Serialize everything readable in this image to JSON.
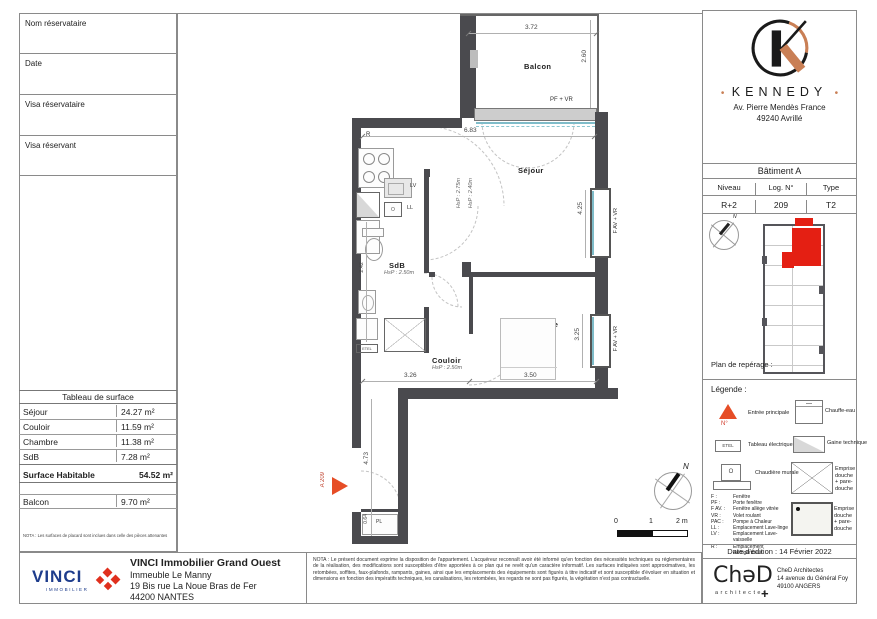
{
  "form": {
    "rows": [
      "Nom réservataire",
      "Date",
      "Visa réservataire",
      "Visa réservant"
    ]
  },
  "brand": {
    "dot": "•",
    "name": "KENNEDY",
    "address1": "Av. Pierre Mendès France",
    "address2": "49240 Avrillé"
  },
  "building": {
    "title": "Bâtiment A",
    "headers": [
      "Niveau",
      "Log. N°",
      "Type"
    ],
    "values": [
      "R+2",
      "209",
      "T2"
    ]
  },
  "reperage": {
    "label": "Plan de repérage :",
    "north": "N"
  },
  "legende": {
    "title": "Légende :",
    "entree": "Entrée principale",
    "entree_sub": "N°",
    "chauffe_eau": "Chauffe-eau",
    "etel": "ETEL",
    "tableau_electrique": "Tableau électrique",
    "gaine": "Gaine technique",
    "chaudiere": "Chaudière murale",
    "chaudiere_icon": "O",
    "emprise1": "Emprise douche + pare-douche",
    "emprise2": "Emprise douche + pare-douche",
    "abbr": [
      {
        "a": "F :",
        "d": "Fenêtre"
      },
      {
        "a": "PF :",
        "d": "Porte fenêtre"
      },
      {
        "a": "F AV. :",
        "d": "Fenêtre allège vitrée"
      },
      {
        "a": "VR :",
        "d": "Volet roulant"
      },
      {
        "a": "PAC :",
        "d": "Pompe à Chaleur"
      },
      {
        "a": "LL :",
        "d": "Emplacement Lave-linge"
      },
      {
        "a": "LV :",
        "d": "Emplacement Lave-vaisselle"
      },
      {
        "a": "R :",
        "d": "Emplacement Réfrigérateur"
      }
    ]
  },
  "edition": {
    "label": "Date d'édition : 14 Février 2022"
  },
  "ched": {
    "logo": "ChəD",
    "sub": "architectes",
    "plus": "+",
    "line1": "CheD Architectes",
    "line2": "14 avenue du Général Foy",
    "line3": "49100 ANGERS"
  },
  "surface": {
    "title": "Tableau de surface",
    "rows": [
      {
        "label": "Séjour",
        "value": "24.27 m²"
      },
      {
        "label": "Couloir",
        "value": "11.59 m²"
      },
      {
        "label": "Chambre",
        "value": "11.38 m²"
      },
      {
        "label": "SdB",
        "value": "7.28 m²"
      }
    ],
    "total_label": "Surface Habitable",
    "total_value": "54.52 m²",
    "balcon_label": "Balcon",
    "balcon_value": "9.70 m²",
    "nota": "NOTA : Les surfaces de placard sont inclues dans celle des pièces attenantes"
  },
  "vinci": {
    "logo": "VINCI",
    "logo_sub": "IMMOBILIER",
    "title": "VINCI Immobilier Grand Ouest",
    "line2": "Immeuble Le Manny",
    "line3": "19 Bis rue La Noue Bras de Fer",
    "line4": "44200 NANTES"
  },
  "nota_main": "NOTA : Le présent document exprime la disposition de l'appartement. L'acquéreur reconnaît avoir été informé qu'en fonction des nécessités techniques ou réglementaires de la réalisation, des modifications sont susceptibles d'être apportées à ce plan qui ne revêt qu'un caractère informatif. Les surfaces indiquées sont approximatives, les retombées, soffites, faux-plafonds, rampants, gaines, ainsi que les emplacements des équipements sont figurés à titre indicatif et sont susceptible d'évoluer en situation et dimensions en fonction des impératifs techniques, les canalisations, les retombées, les regards ne sont pas figurés, la végétation n'est pas contractuelle.",
  "plan": {
    "rooms": {
      "balcon": "Balcon",
      "sejour": "Séjour",
      "chambre": "Chambre",
      "couloir": "Couloir",
      "sdb": "SdB"
    },
    "hsp": {
      "sejour_a": "HsP : 2.75m",
      "sejour_b": "HsP : 2.40m",
      "sdb": "HsP : 2.50m",
      "chambre": "HsP : 2.47m",
      "couloir": "HsP : 2.50m"
    },
    "dims": {
      "balcon_w": "3.72",
      "balcon_h": "2.60",
      "sejour_w": "6.83",
      "sejour_h": "4.25",
      "chambre_h": "3.25",
      "couloir_w": "3.26",
      "chambre_w": "3.50",
      "entry_h": "4.73",
      "sdb_h": "2.42",
      "pl_w": "0.64"
    },
    "openings": {
      "pf_vr": "PF + VR",
      "fav_vr_1": "F AV + VR",
      "fav_vr_2": "F AV + VR"
    },
    "equip": {
      "r": "R",
      "lv": "LV",
      "ll": "LL",
      "o": "O",
      "etel": "ETEL",
      "pl": "PL"
    },
    "unit": "A 209",
    "scale": {
      "s0": "0",
      "s1": "1",
      "s2": "2 m"
    },
    "north": "N"
  }
}
